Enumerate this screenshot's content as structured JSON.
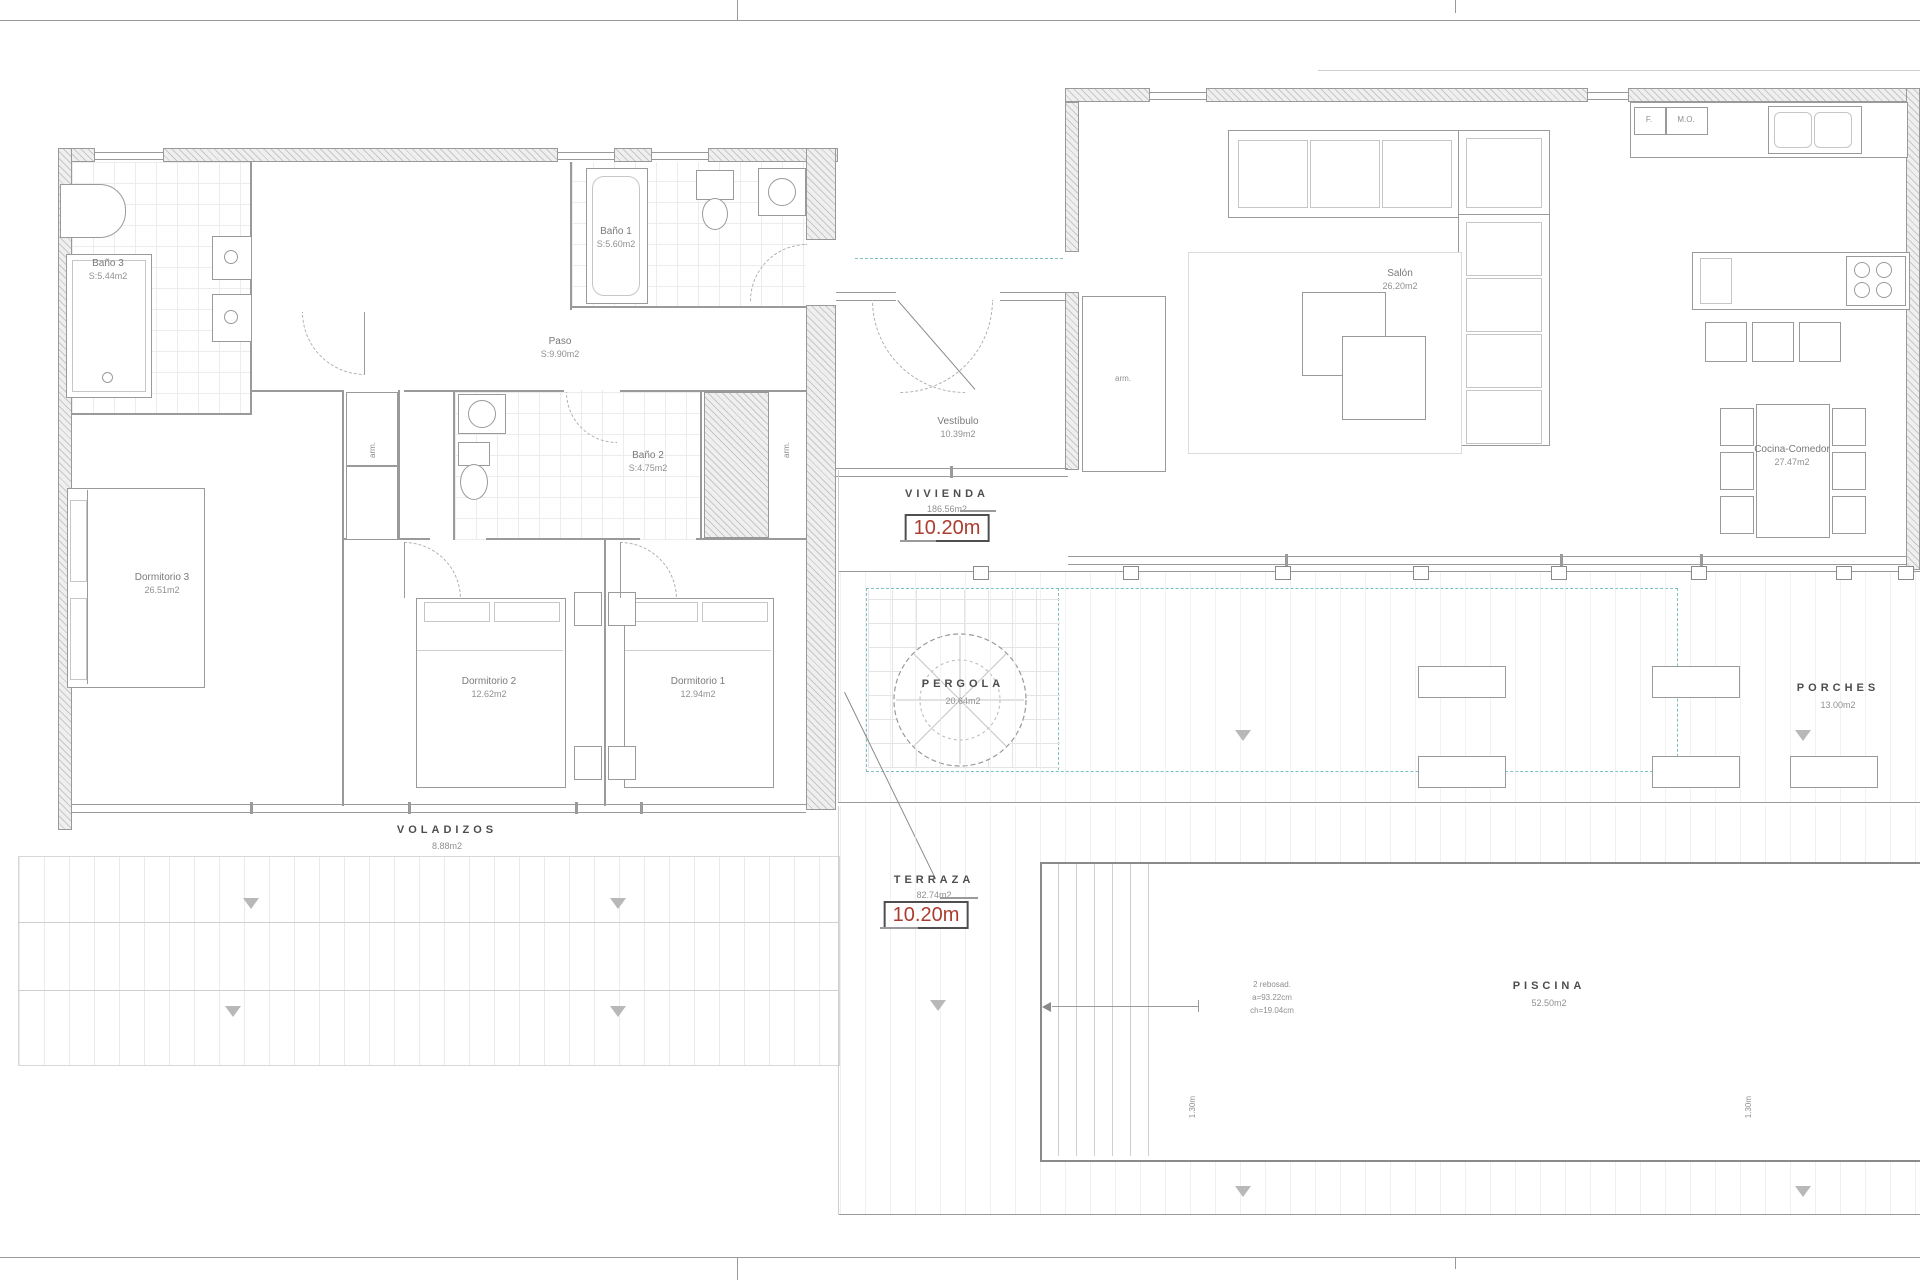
{
  "rooms": {
    "bano3": {
      "name": "Baño 3",
      "area": "S:5.44m2"
    },
    "bano1": {
      "name": "Baño 1",
      "area": "S:5.60m2"
    },
    "bano2": {
      "name": "Baño 2",
      "area": "S:4.75m2"
    },
    "paso": {
      "name": "Paso",
      "area": "S:9.90m2"
    },
    "dorm3": {
      "name": "Dormitorio 3",
      "area": "26.51m2"
    },
    "dorm2": {
      "name": "Dormitorio 2",
      "area": "12.62m2"
    },
    "dorm1": {
      "name": "Dormitorio 1",
      "area": "12.94m2"
    },
    "vestibulo": {
      "name": "Vestíbulo",
      "area": "10.39m2"
    },
    "salon": {
      "name": "Salón",
      "area": "26.20m2"
    },
    "cocina": {
      "name": "Cocina-Comedor",
      "area": "27.47m2"
    },
    "vivienda": {
      "name": "VIVIENDA",
      "area": "186.56m2",
      "dim": "10.20m"
    },
    "pergola": {
      "name": "PERGOLA",
      "area": "20.64m2"
    },
    "porches": {
      "name": "PORCHES",
      "area": "13.00m2"
    },
    "voladizos": {
      "name": "VOLADIZOS",
      "area": "8.88m2"
    },
    "terraza": {
      "name": "TERRAZA",
      "area": "82.74m2",
      "dim": "10.20m"
    },
    "piscina": {
      "name": "PISCINA",
      "area": "52.50m2"
    }
  },
  "annotations": {
    "closet": "arm.",
    "fridge": "F.",
    "microwave": "M.O.",
    "pool_note1": "2 rebosad.",
    "pool_note2": "a=93.22cm",
    "pool_note3": "ch=19.04cm",
    "pool_depth": "1.30m"
  },
  "colors": {
    "accent_red": "#ab3c30",
    "teal_dashed": "#7ec0c0",
    "line_gray": "#9a9a9a",
    "text_gray": "#7a7a7a"
  }
}
